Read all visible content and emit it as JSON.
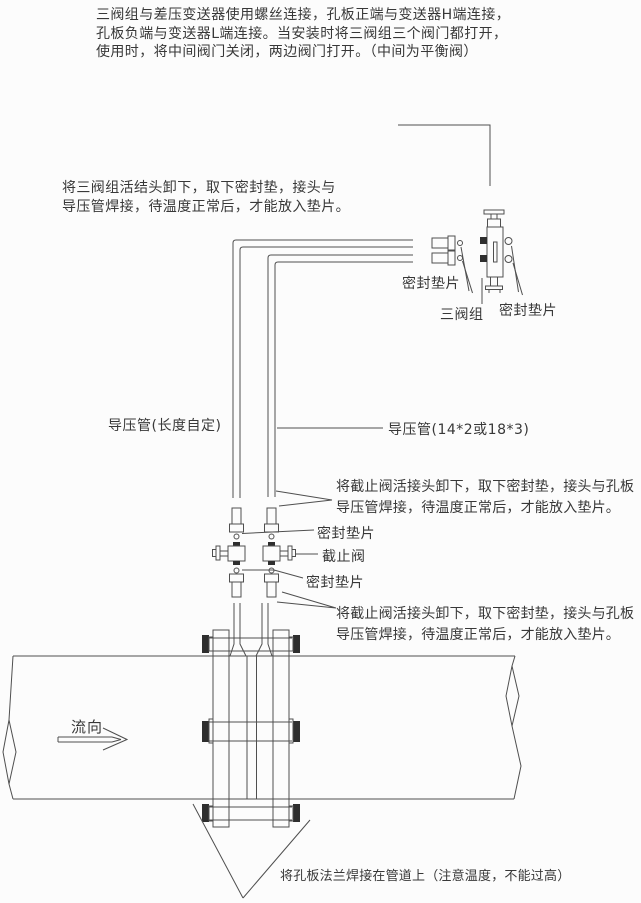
{
  "colors": {
    "background": "#fcfcfc",
    "line": "#4f4f4f",
    "dark_fill": "#2e2e2e",
    "text": "#383838"
  },
  "paragraphs": {
    "top": [
      "三阀组与差压变送器使用螺丝连接，孔板正端与变送器H端连接，",
      "孔板负端与变送器L端连接。当安装时将三阀组三个阀门都打开，",
      "使用时，将中间阀门关闭，两边阀门打开。（中间为平衡阀）"
    ],
    "manifold_weld_note": [
      "将三阀组活结头卸下，取下密封垫，接头与",
      "导压管焊接，待温度正常后，才能放入垫片。"
    ],
    "stop_valve_weld_note_upper": [
      "将截止阀活接头卸下，取下密封垫，接头与孔板",
      "导压管焊接，待温度正常后，才能放入垫片。"
    ],
    "stop_valve_weld_note_lower": [
      "将截止阀活接头卸下，取下密封垫，接头与孔板",
      "导压管焊接，待温度正常后，才能放入垫片。"
    ]
  },
  "labels": {
    "seal_gasket_manifold_left": "密封垫片",
    "three_valve_manifold": "三阀组",
    "seal_gasket_manifold_right": "密封垫片",
    "impulse_pipe_length": "导压管(长度自定)",
    "impulse_pipe_spec": "导压管(14*2或18*3)",
    "seal_gasket_valve_upper": "密封垫片",
    "stop_valve": "截止阀",
    "seal_gasket_valve_lower": "密封垫片",
    "flow_direction": "流向",
    "flange_weld_note": "将孔板法兰焊接在管道上（注意温度，不能过高）"
  }
}
